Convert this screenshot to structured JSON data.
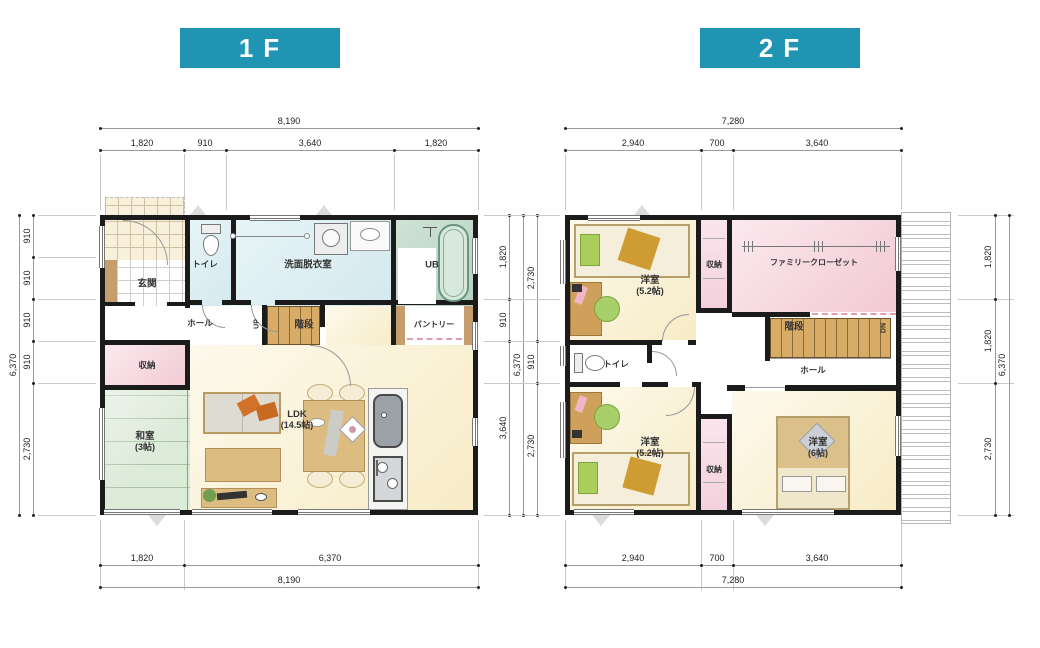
{
  "colors": {
    "title_bg": "#2095b3",
    "wall": "#1b1b1b",
    "ldk_floor": "#f8eeca",
    "tatami": "#dcead8",
    "washroom": "#d4e9ef",
    "bath": "#b5d3c2",
    "closet_pink": "#f2c9d4",
    "stair_wood": "#d8ab67"
  },
  "f1": {
    "title": "1F",
    "rooms": {
      "entrance": "玄関",
      "toilet": "トイレ",
      "washroom": "洗面脱衣室",
      "bath": "UB",
      "hall": "ホール",
      "up": "UP",
      "stairs": "階段",
      "pantry": "パントリー",
      "storage": "収納",
      "tatami": "和室",
      "tatami_size": "(3帖)",
      "ldk": "LDK",
      "ldk_size": "(14.5帖)"
    },
    "dims": {
      "top_total": "8,190",
      "top": [
        "1,820",
        "910",
        "3,640",
        "1,820"
      ],
      "left_total": "6,370",
      "left": [
        "910",
        "910",
        "910",
        "910",
        "2,730"
      ],
      "right": [
        "1,820",
        "910",
        "3,640"
      ],
      "right_total": "6,370",
      "bottom": [
        "1,820",
        "6,370"
      ],
      "bottom_total": "8,190"
    }
  },
  "f2": {
    "title": "2F",
    "rooms": {
      "bedroom_a": "洋室",
      "bedroom_a_size": "(5.2帖)",
      "closet_top": "収納",
      "family_closet": "ファミリークローゼット",
      "stairs": "階段",
      "dn": "DN",
      "hall": "ホール",
      "toilet": "トイレ",
      "bedroom_b": "洋室",
      "bedroom_b_size": "(5.2帖)",
      "closet_bottom": "収納",
      "bedroom_c": "洋室",
      "bedroom_c_size": "(6帖)"
    },
    "dims": {
      "top_total": "7,280",
      "top": [
        "2,940",
        "700",
        "3,640"
      ],
      "left": [
        "2,730",
        "910",
        "2,730"
      ],
      "right": [
        "1,820",
        "1,820",
        "2,730"
      ],
      "right_total": "6,370",
      "bottom": [
        "2,940",
        "700",
        "3,640"
      ],
      "bottom_total": "7,280"
    }
  }
}
